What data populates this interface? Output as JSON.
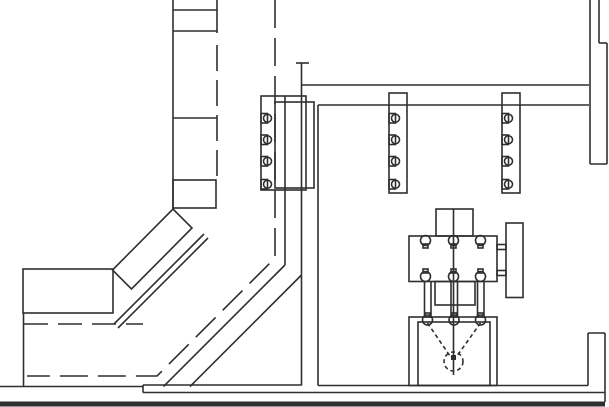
{
  "meta": {
    "type": "cad-line-drawing",
    "canvas": {
      "width": 609,
      "height": 407
    },
    "colors": {
      "background": "#ffffff",
      "line": "#2f2f2f"
    }
  },
  "drawing": {
    "filled": [
      [
        "floor-band",
        0,
        401.5,
        605,
        5
      ],
      [
        "funnel-center-node",
        451,
        355,
        5,
        5
      ]
    ],
    "rects": [
      [
        "conveyor-horizontal-box",
        23,
        269,
        90,
        44
      ],
      [
        "conveyor-segment-box",
        173,
        180,
        43,
        28
      ],
      [
        "wall-plate-outer",
        261,
        96,
        45,
        94
      ],
      [
        "wall-plate-inner",
        275,
        102,
        39,
        86
      ],
      [
        "rack-column-left",
        389,
        93,
        18,
        100
      ],
      [
        "rack-column-right",
        502,
        93,
        18,
        100
      ],
      [
        "machine-top-block",
        436,
        209,
        37,
        27
      ],
      [
        "machine-body",
        409,
        236,
        88,
        45.5
      ],
      [
        "machine-mid-block",
        435,
        281.5,
        40,
        23.5
      ],
      [
        "machine-base-outer",
        409,
        317,
        88,
        68.5
      ],
      [
        "machine-base-inner",
        418,
        322,
        72,
        63.5
      ],
      [
        "machine-flange",
        506,
        223,
        17,
        74.5
      ],
      [
        "machine-connector-upper",
        497,
        244.5,
        9,
        5
      ],
      [
        "machine-connector-lower",
        497,
        270.5,
        9,
        5
      ],
      [
        "plate-notch-square",
        261,
        113.5,
        6.5,
        9.5
      ],
      [
        "plate-notch-square",
        261,
        135,
        6.5,
        9.5
      ],
      [
        "plate-notch-square",
        261,
        156.5,
        6.5,
        9.5
      ],
      [
        "plate-notch-square",
        261,
        179.5,
        6.5,
        9.5
      ],
      [
        "rack-left-notch-square",
        389,
        113.5,
        6.5,
        9.5
      ],
      [
        "rack-left-notch-square",
        389,
        135,
        6.5,
        9.5
      ],
      [
        "rack-left-notch-square",
        389,
        156.5,
        6.5,
        9.5
      ],
      [
        "rack-left-notch-square",
        389,
        179.5,
        6.5,
        9.5
      ],
      [
        "rack-right-notch-square",
        502,
        113.5,
        6.5,
        9.5
      ],
      [
        "rack-right-notch-square",
        502,
        135,
        6.5,
        9.5
      ],
      [
        "rack-right-notch-square",
        502,
        156.5,
        6.5,
        9.5
      ],
      [
        "rack-right-notch-square",
        502,
        179.5,
        6.5,
        9.5
      ],
      [
        "circle-tab",
        423,
        244,
        5,
        4
      ],
      [
        "circle-tab",
        451,
        244,
        5,
        4
      ],
      [
        "circle-tab",
        478,
        244,
        5,
        4
      ],
      [
        "circle-tab",
        423,
        269,
        5,
        4
      ],
      [
        "circle-tab",
        451,
        269,
        5,
        4
      ],
      [
        "circle-tab",
        478,
        269,
        5,
        4
      ],
      [
        "circle-tab",
        425,
        313,
        5,
        4
      ],
      [
        "circle-tab",
        451.5,
        313,
        5,
        4
      ],
      [
        "circle-tab",
        478,
        313,
        5,
        4
      ]
    ],
    "polygons": [
      {
        "name": "conveyor-diagonal-panel",
        "points": "112.5,270 173,209 192,228 131.5,289"
      }
    ],
    "lines": [
      [
        "conveyor-left-rail",
        173,
        0,
        173,
        209
      ],
      [
        "conveyor-right-rail-top",
        217,
        0,
        217,
        33
      ],
      [
        "conveyor-divider-1",
        173,
        10,
        217,
        10
      ],
      [
        "conveyor-divider-2",
        173,
        31,
        217,
        31
      ],
      [
        "conveyor-divider-3",
        173,
        118,
        217,
        118
      ],
      [
        "conveyor-inner-rail-a",
        114,
        324,
        204,
        234
      ],
      [
        "conveyor-inner-rail-b",
        118,
        328,
        208,
        238
      ],
      [
        "conveyor-left-leg",
        23.5,
        313,
        23.5,
        386.5
      ],
      [
        "chute-side-vertical",
        285,
        96,
        285,
        265
      ],
      [
        "chute-side-diagonal-a",
        285,
        265,
        163.5,
        386.5
      ],
      [
        "chute-side-diagonal-b",
        301.5,
        275,
        190,
        386.5
      ],
      [
        "wall-left-vertical",
        301.5,
        63,
        301.5,
        385.5
      ],
      [
        "wall-top-cap",
        296,
        63,
        309,
        63
      ],
      [
        "wall-right-vertical",
        318,
        105,
        318,
        385.5
      ],
      [
        "wall-upper-horizontal",
        301.5,
        85,
        589,
        85
      ],
      [
        "wall-lower-horizontal",
        318,
        105,
        589,
        105
      ],
      [
        "floor-left-top",
        0,
        386.5,
        143,
        386.5
      ],
      [
        "floor-step",
        143,
        385,
        143,
        392.5
      ],
      [
        "floor-mid-top",
        143,
        385,
        301.5,
        385
      ],
      [
        "floor-right-top",
        318,
        385.5,
        588,
        385.5
      ],
      [
        "floor-sub-line",
        143,
        392.5,
        605,
        392.5
      ],
      [
        "right-wall-line-1",
        590,
        0,
        590,
        164
      ],
      [
        "right-wall-line-2",
        599,
        0,
        599,
        43
      ],
      [
        "right-wall-line-3",
        607,
        43,
        607,
        164
      ],
      [
        "right-wall-step-cap",
        599,
        43,
        607,
        43
      ],
      [
        "right-wall-bottom-cap",
        590,
        164,
        607,
        164
      ],
      [
        "corner-wall-inner",
        588,
        333,
        588,
        385.5
      ],
      [
        "corner-wall-outer",
        605,
        333,
        605,
        402
      ],
      [
        "corner-wall-cap",
        588,
        333,
        605,
        333
      ],
      [
        "machine-centerline",
        453.5,
        209,
        453.5,
        375
      ],
      [
        "rod-1a",
        424.5,
        281,
        424.5,
        317
      ],
      [
        "rod-1b",
        431,
        281,
        431,
        317
      ],
      [
        "rod-2a",
        451,
        281,
        451,
        317
      ],
      [
        "rod-2b",
        457.5,
        281,
        457.5,
        317
      ],
      [
        "rod-3a",
        477.5,
        281,
        477.5,
        317
      ],
      [
        "rod-3b",
        484,
        281,
        484,
        317
      ]
    ],
    "dashed": [
      {
        "name": "conveyor-centerline-dashed",
        "points": "275,0 275,258 157,376 27,376",
        "dash": "28 10"
      },
      {
        "name": "conveyor-right-rail-hidden",
        "points": "217,45 217,180",
        "dash": "26 9"
      },
      {
        "name": "conveyor-box-hidden-line",
        "points": "24,324 143,324",
        "dash": "24 10"
      },
      {
        "name": "funnel-dashed-left",
        "points": "427.5,323 450,356",
        "dash": "4 3"
      },
      {
        "name": "funnel-dashed-right",
        "points": "480.5,323 457,356",
        "dash": "4 3"
      }
    ],
    "circles": [
      [
        "plate-notch-circle",
        267.5,
        118.25,
        4
      ],
      [
        "plate-notch-circle",
        267.5,
        139.75,
        4
      ],
      [
        "plate-notch-circle",
        267.5,
        161.25,
        4
      ],
      [
        "plate-notch-circle",
        267.5,
        184.25,
        4
      ],
      [
        "rack-left-notch-circle",
        395.5,
        118.25,
        4
      ],
      [
        "rack-left-notch-circle",
        395.5,
        139.75,
        4
      ],
      [
        "rack-left-notch-circle",
        395.5,
        161.25,
        4
      ],
      [
        "rack-left-notch-circle",
        395.5,
        184.25,
        4
      ],
      [
        "rack-right-notch-circle",
        508.5,
        118.25,
        4
      ],
      [
        "rack-right-notch-circle",
        508.5,
        139.75,
        4
      ],
      [
        "rack-right-notch-circle",
        508.5,
        161.25,
        4
      ],
      [
        "rack-right-notch-circle",
        508.5,
        184.25,
        4
      ],
      [
        "machine-body-top-circle",
        425.5,
        240.5,
        5
      ],
      [
        "machine-body-top-circle",
        453.5,
        240.5,
        5
      ],
      [
        "machine-body-top-circle",
        480.5,
        240.5,
        5
      ],
      [
        "machine-body-bottom-circle",
        425.5,
        276.5,
        5
      ],
      [
        "machine-body-bottom-circle",
        453.5,
        276.5,
        5
      ],
      [
        "machine-body-bottom-circle",
        480.5,
        276.5,
        5
      ],
      [
        "machine-base-circle",
        427.5,
        320,
        5
      ],
      [
        "machine-base-circle",
        454,
        320,
        5
      ],
      [
        "machine-base-circle",
        480.5,
        320,
        5
      ],
      [
        "funnel-dashed-circle",
        453.5,
        361.5,
        9.5,
        "4 3"
      ]
    ]
  }
}
